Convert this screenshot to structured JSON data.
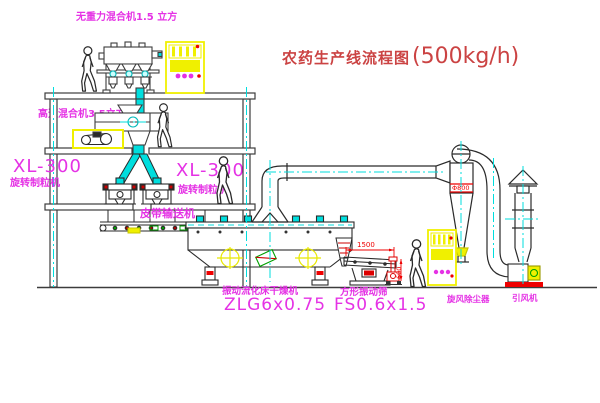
{
  "title": {
    "text": "农药生产线流程图",
    "capacity": "(500kg/h)"
  },
  "equipment_labels": {
    "weightless_mixer": "无重力混合机1.5 立方",
    "high_speed_mixer": "高速混合机3.5立方",
    "granulator_left_model": "XL-300",
    "granulator_left_name": "旋转制粒机",
    "granulator_right_model": "XL-300",
    "granulator_right_name": "旋转制粒机",
    "belt_conveyor": "皮带输送机",
    "dryer_name": "振动流化床干燥机",
    "dryer_model": "ZLG6x0.75",
    "screen_name": "方形振动筛",
    "screen_model": "FS0.6x1.5",
    "cyclone": "旋风除尘器",
    "fan": "引风机"
  },
  "dimensions": {
    "screen_length": "1500",
    "screen_width": "600",
    "cyclone_diameter": "Φ800"
  },
  "colors": {
    "line": "#3c3c3c",
    "equipment_accent_yellow": "#f0f000",
    "centerline_cyan": "#00dede",
    "label_magenta": "#e532e5",
    "dimension_red": "#ee0000",
    "title_red": "#cb4343",
    "detail_green": "#00a000"
  }
}
